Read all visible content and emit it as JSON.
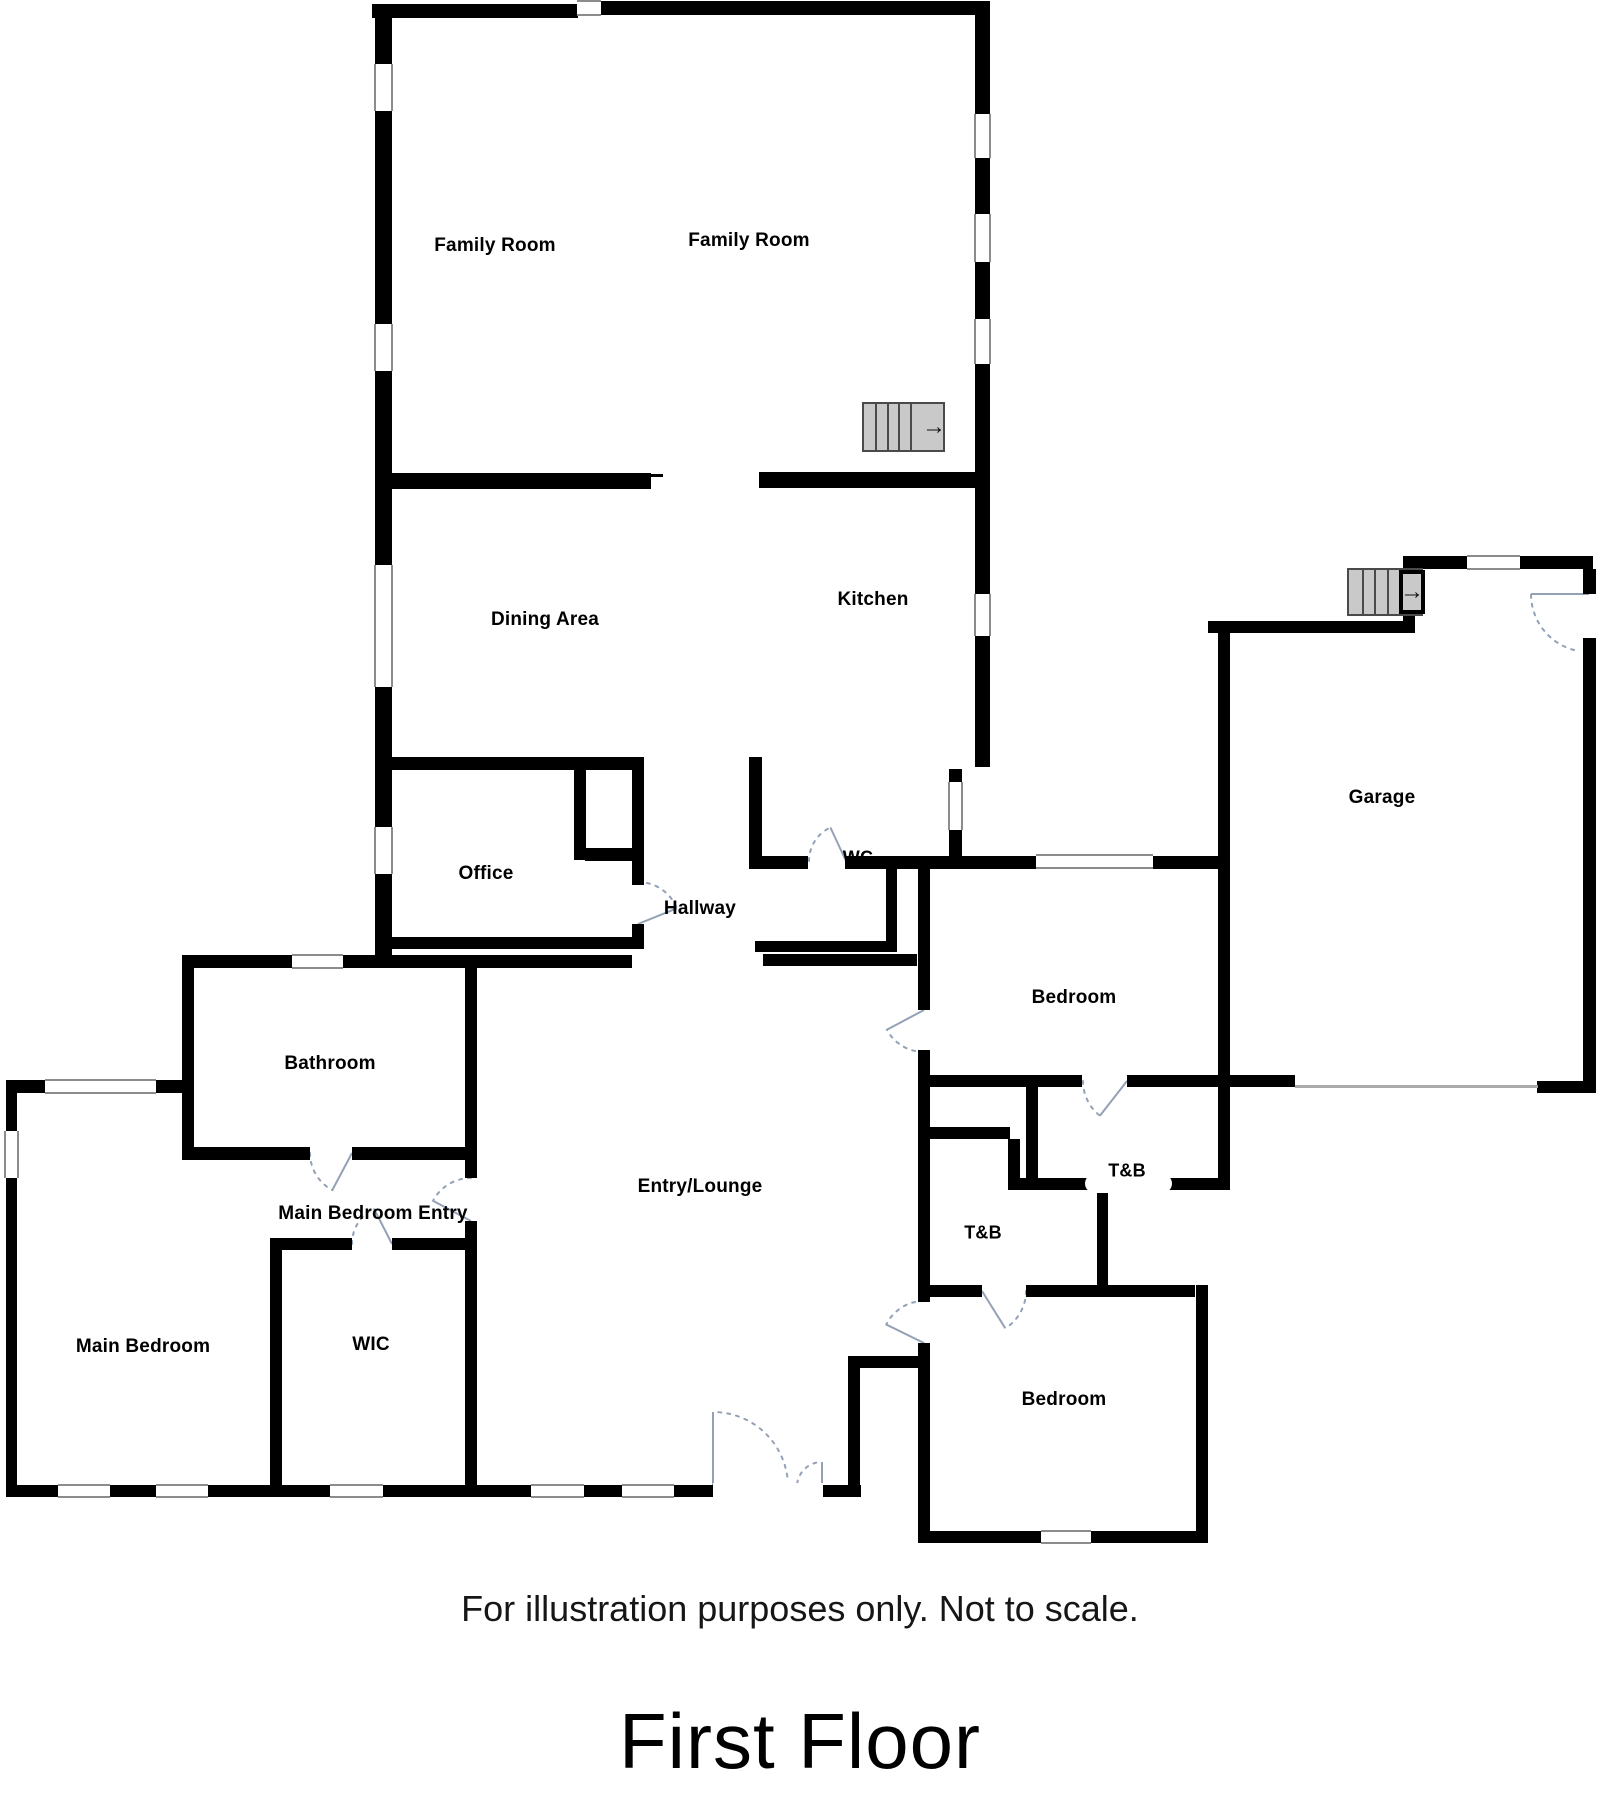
{
  "page": {
    "title": "First Floor",
    "disclaimer": "For illustration purposes only. Not to scale."
  },
  "colors": {
    "wall": "#000000",
    "stairs_fill": "#c9c9c9",
    "stairs_border": "#4a4a4a",
    "door_arc": "#93a1b5",
    "window_edge": "#8c8c8c",
    "garage_door_line": "#aaaaaa",
    "text": "#000000"
  },
  "floorplan": {
    "width": 1600,
    "height": 1820,
    "walls": [
      [
        372,
        4,
        206,
        14
      ],
      [
        601,
        1,
        389,
        14
      ],
      [
        375,
        4,
        17,
        963
      ],
      [
        975,
        1,
        15,
        766
      ],
      [
        389,
        473,
        262,
        16
      ],
      [
        759,
        472,
        229,
        16
      ],
      [
        383,
        757,
        261,
        13
      ],
      [
        574,
        767,
        12,
        93
      ],
      [
        585,
        848,
        59,
        13
      ],
      [
        632,
        757,
        12,
        128
      ],
      [
        632,
        924,
        12,
        25
      ],
      [
        383,
        937,
        261,
        12
      ],
      [
        185,
        955,
        447,
        13
      ],
      [
        749,
        757,
        13,
        112
      ],
      [
        762,
        856,
        46,
        13
      ],
      [
        845,
        856,
        192,
        13
      ],
      [
        1152,
        856,
        78,
        13
      ],
      [
        949,
        769,
        13,
        99
      ],
      [
        755,
        941,
        132,
        11
      ],
      [
        763,
        954,
        154,
        12
      ],
      [
        886,
        868,
        11,
        84
      ],
      [
        182,
        955,
        12,
        205
      ],
      [
        193,
        1147,
        117,
        13
      ],
      [
        352,
        1147,
        125,
        13
      ],
      [
        465,
        955,
        12,
        223
      ],
      [
        465,
        1221,
        12,
        276
      ],
      [
        6,
        1080,
        176,
        13
      ],
      [
        6,
        1080,
        11,
        417
      ],
      [
        6,
        1485,
        855,
        12
      ],
      [
        270,
        1238,
        12,
        248
      ],
      [
        282,
        1238,
        70,
        12
      ],
      [
        392,
        1238,
        73,
        12
      ],
      [
        848,
        1356,
        70,
        12
      ],
      [
        848,
        1368,
        12,
        118
      ],
      [
        918,
        856,
        12,
        154
      ],
      [
        918,
        1050,
        12,
        252
      ],
      [
        918,
        1343,
        12,
        200
      ],
      [
        930,
        1127,
        80,
        12
      ],
      [
        1026,
        1087,
        12,
        93
      ],
      [
        1008,
        1139,
        12,
        51
      ],
      [
        930,
        1075,
        152,
        12
      ],
      [
        1127,
        1075,
        133,
        12
      ],
      [
        1008,
        1178,
        222,
        12
      ],
      [
        1097,
        1190,
        11,
        107
      ],
      [
        930,
        1285,
        52,
        12
      ],
      [
        1026,
        1285,
        169,
        12
      ],
      [
        1196,
        1285,
        12,
        258
      ],
      [
        918,
        1531,
        290,
        12
      ],
      [
        1218,
        627,
        12,
        563
      ],
      [
        1208,
        621,
        207,
        12
      ],
      [
        1403,
        556,
        12,
        71
      ],
      [
        1403,
        556,
        190,
        13
      ],
      [
        1583,
        569,
        13,
        25
      ],
      [
        1583,
        638,
        13,
        455
      ],
      [
        1537,
        1081,
        59,
        12
      ],
      [
        1232,
        1075,
        63,
        12
      ]
    ],
    "windows": [
      [
        374,
        64,
        19,
        47,
        "v"
      ],
      [
        374,
        324,
        19,
        47,
        "v"
      ],
      [
        374,
        565,
        19,
        122,
        "v"
      ],
      [
        374,
        827,
        19,
        47,
        "v"
      ],
      [
        974,
        114,
        17,
        44,
        "v"
      ],
      [
        974,
        214,
        17,
        48,
        "v"
      ],
      [
        974,
        319,
        17,
        45,
        "v"
      ],
      [
        974,
        594,
        17,
        42,
        "v"
      ],
      [
        577,
        0,
        24,
        16,
        "h"
      ],
      [
        948,
        782,
        15,
        48,
        "v"
      ],
      [
        292,
        954,
        51,
        15,
        "h"
      ],
      [
        45,
        1079,
        111,
        15,
        "h"
      ],
      [
        4,
        1131,
        15,
        47,
        "v"
      ],
      [
        58,
        1484,
        52,
        14,
        "h"
      ],
      [
        156,
        1484,
        52,
        14,
        "h"
      ],
      [
        330,
        1484,
        53,
        14,
        "h"
      ],
      [
        531,
        1484,
        53,
        14,
        "h"
      ],
      [
        622,
        1484,
        52,
        14,
        "h"
      ],
      [
        1036,
        854,
        117,
        15,
        "h"
      ],
      [
        1041,
        1530,
        50,
        14,
        "h"
      ],
      [
        1467,
        555,
        53,
        15,
        "h"
      ]
    ],
    "openings": [
      {
        "x": 713,
        "y": 1483,
        "w": 110,
        "h": 16,
        "pill": false
      },
      {
        "x": 1085,
        "y": 1174,
        "w": 87,
        "h": 19,
        "pill": true
      }
    ],
    "thin_lines": [
      {
        "x": 1295,
        "y": 1085,
        "w": 243,
        "h": 3,
        "color": "garage_door_line"
      },
      {
        "x": 651,
        "y": 474,
        "w": 12,
        "h": 3,
        "color": "wall"
      }
    ],
    "stairs": [
      {
        "x": 862,
        "y": 402,
        "w": 83,
        "h": 50,
        "treads": 4,
        "arrow_zone": 26,
        "boxed": false
      },
      {
        "x": 1347,
        "y": 568,
        "w": 76,
        "h": 48,
        "treads": 3,
        "arrow_zone": 26,
        "boxed": true
      }
    ],
    "doors": [
      {
        "name": "wc-door",
        "cx": 846,
        "cy": 861,
        "r": 37,
        "from": 180,
        "to": 245
      },
      {
        "name": "office-door",
        "cx": 638,
        "cy": 924,
        "r": 42,
        "from": 270,
        "to": 338
      },
      {
        "name": "bathroom-door",
        "cx": 352,
        "cy": 1153,
        "r": 42,
        "from": 180,
        "to": 118
      },
      {
        "name": "main-bedroom-entry-door",
        "cx": 471,
        "cy": 1221,
        "r": 43,
        "from": 270,
        "to": 208
      },
      {
        "name": "wic-door",
        "cx": 392,
        "cy": 1244,
        "r": 40,
        "from": 180,
        "to": 243
      },
      {
        "name": "bedroom-upper-door",
        "cx": 924,
        "cy": 1010,
        "r": 42,
        "from": 90,
        "to": 152
      },
      {
        "name": "bedroom-lower-door",
        "cx": 924,
        "cy": 1343,
        "r": 42,
        "from": 270,
        "to": 206
      },
      {
        "name": "tb-upper-door",
        "cx": 1127,
        "cy": 1081,
        "r": 44,
        "from": 180,
        "to": 128
      },
      {
        "name": "tb-lower-door",
        "cx": 982,
        "cy": 1291,
        "r": 44,
        "from": 0,
        "to": 58
      },
      {
        "name": "front-door-left",
        "cx": 713,
        "cy": 1487,
        "r": 75,
        "from": 352,
        "to": 270
      },
      {
        "name": "front-door-right",
        "cx": 822,
        "cy": 1487,
        "r": 25,
        "from": 188,
        "to": 270
      },
      {
        "name": "garage-side-door",
        "cx": 1589,
        "cy": 594,
        "r": 58,
        "from": 105,
        "to": 180
      }
    ],
    "labels": [
      {
        "name": "family-room-left",
        "text": "Family Room",
        "x": 495,
        "y": 246,
        "size": 19
      },
      {
        "name": "family-room-right",
        "text": "Family Room",
        "x": 749,
        "y": 241,
        "size": 19
      },
      {
        "name": "dining-area",
        "text": "Dining Area",
        "x": 545,
        "y": 620,
        "size": 19
      },
      {
        "name": "kitchen",
        "text": "Kitchen",
        "x": 873,
        "y": 600,
        "size": 19
      },
      {
        "name": "office",
        "text": "Office",
        "x": 486,
        "y": 874,
        "size": 19
      },
      {
        "name": "hallway",
        "text": "Hallway",
        "x": 700,
        "y": 909,
        "size": 19
      },
      {
        "name": "wc",
        "text": "WC",
        "x": 858,
        "y": 858,
        "size": 18
      },
      {
        "name": "bathroom",
        "text": "Bathroom",
        "x": 330,
        "y": 1064,
        "size": 19
      },
      {
        "name": "main-bedroom-entry",
        "text": "Main Bedroom Entry",
        "x": 373,
        "y": 1214,
        "size": 19
      },
      {
        "name": "main-bedroom",
        "text": "Main Bedroom",
        "x": 143,
        "y": 1347,
        "size": 19
      },
      {
        "name": "wic",
        "text": "WIC",
        "x": 371,
        "y": 1345,
        "size": 19
      },
      {
        "name": "entry-lounge",
        "text": "Entry/Lounge",
        "x": 700,
        "y": 1187,
        "size": 19
      },
      {
        "name": "bedroom-upper",
        "text": "Bedroom",
        "x": 1074,
        "y": 998,
        "size": 19
      },
      {
        "name": "tb-upper",
        "text": "T&B",
        "x": 1127,
        "y": 1171,
        "size": 18
      },
      {
        "name": "tb-lower",
        "text": "T&B",
        "x": 983,
        "y": 1233,
        "size": 18
      },
      {
        "name": "bedroom-lower",
        "text": "Bedroom",
        "x": 1064,
        "y": 1400,
        "size": 19
      },
      {
        "name": "garage",
        "text": "Garage",
        "x": 1382,
        "y": 798,
        "size": 19
      }
    ]
  }
}
